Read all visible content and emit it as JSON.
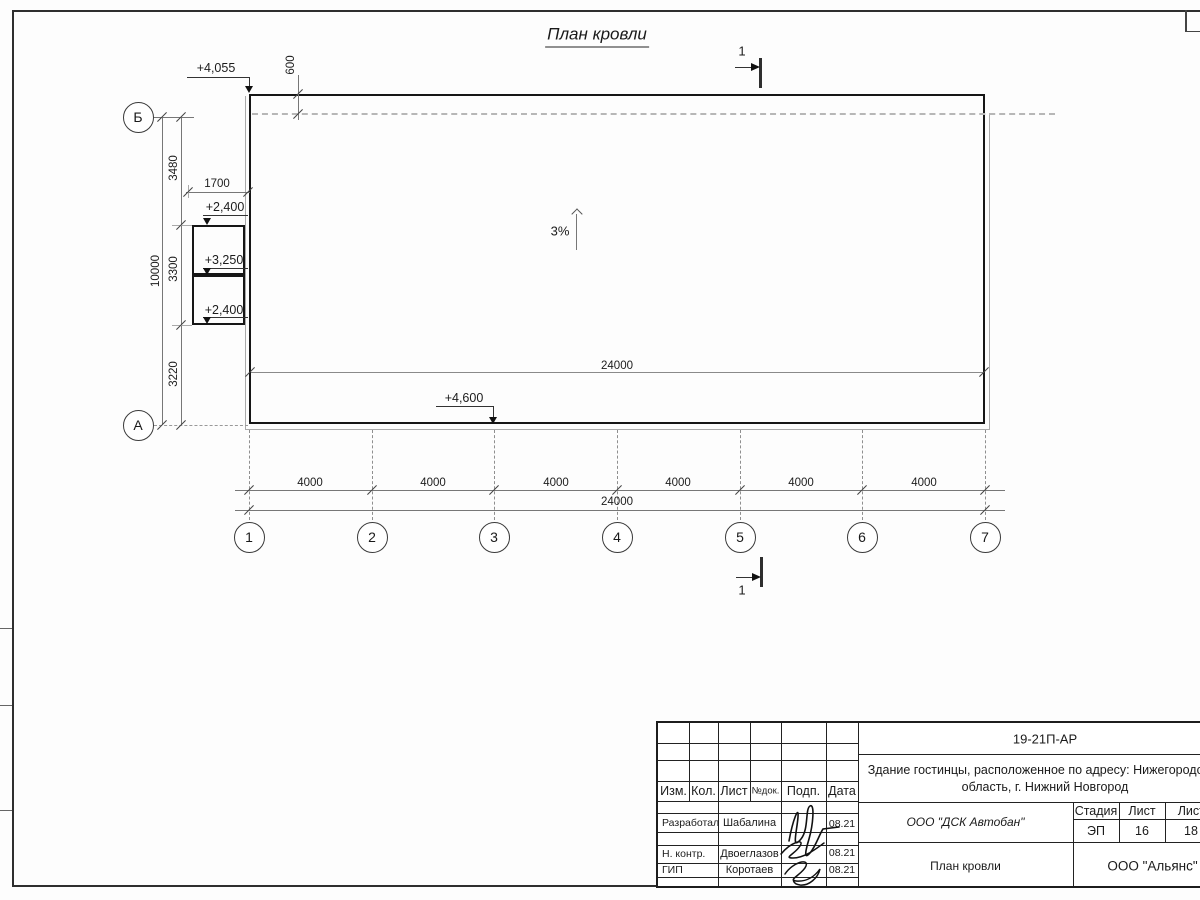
{
  "colors": {
    "ink": "#1a1a1a",
    "thin_line": "#8a8a8a",
    "dashed_line": "#b7b7b7",
    "paper": "#ffffff"
  },
  "drawing": {
    "title": "План кровли",
    "slope_label": "3%",
    "section_label_top": "1",
    "section_label_bottom": "1",
    "elevations": {
      "top_left": "+4,055",
      "canopy_top": "+2,400",
      "canopy_mid": "+3,250",
      "canopy_bottom": "+2,400",
      "bottom": "+4,600"
    },
    "dims": {
      "parapet": "600",
      "canopy_width": "1700",
      "v1": "3480",
      "v2": "3300",
      "v3": "3220",
      "v_total": "10000",
      "bay": "4000",
      "total": "24000",
      "total_inner": "24000"
    },
    "axes": {
      "cols": [
        "1",
        "2",
        "3",
        "4",
        "5",
        "6",
        "7"
      ],
      "rows": [
        "Б",
        "А"
      ]
    }
  },
  "title_block": {
    "doc_number": "19-21П-АР",
    "project_line1": "Здание гостинцы, расположенное по адресу: Нижегородская",
    "project_line2": "область, г. Нижний Новгород",
    "headers": {
      "izm": "Изм.",
      "kol": "Кол.",
      "list": "Лист",
      "ndok": "№док.",
      "podp": "Подп.",
      "data": "Дата",
      "stage": "Стадия",
      "sheet": "Лист",
      "sheets": "Листов"
    },
    "rows": [
      {
        "role": "Разработал",
        "name": "Шабалина",
        "date": "08.21"
      },
      {
        "role": "Н. контр.",
        "name": "Двоеглазов",
        "date": "08.21"
      },
      {
        "role": "ГИП",
        "name": "Коротаев",
        "date": "08.21"
      }
    ],
    "company": "ООО \"ДСК Автобан\"",
    "stage_value": "ЭП",
    "sheet_value": "16",
    "sheets_value": "18",
    "sheet_title": "План кровли",
    "org": "ООО \"Альянс\""
  }
}
